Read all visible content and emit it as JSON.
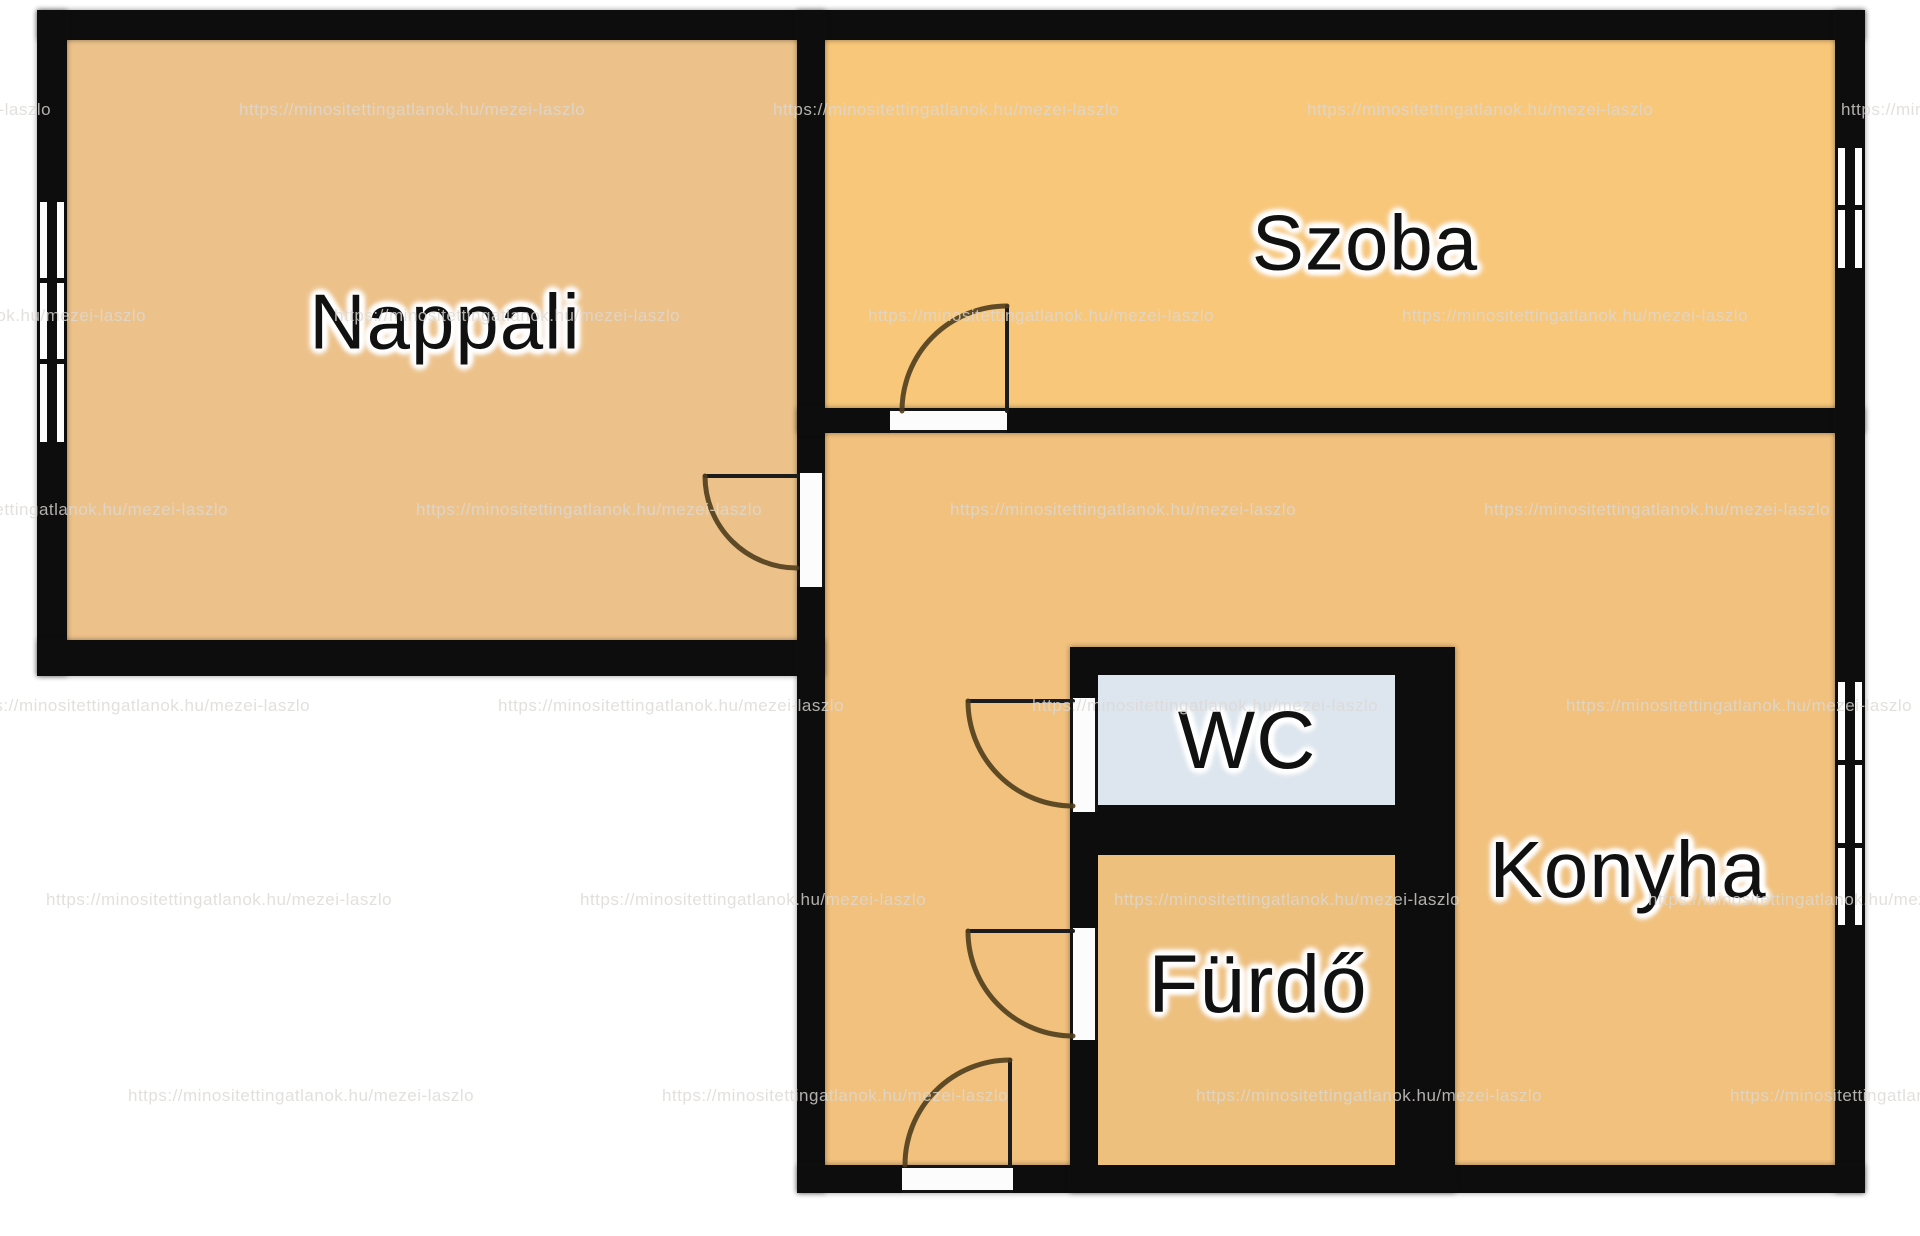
{
  "watermark": {
    "text": "https://minositettingatlanok.hu/mezei-laszlo",
    "color": "#dcd9d4",
    "pitch": 534,
    "rows": [
      {
        "y": 100,
        "x0": -295
      },
      {
        "y": 306,
        "x0": -200
      },
      {
        "y": 500,
        "x0": -118
      },
      {
        "y": 696,
        "x0": -36
      },
      {
        "y": 890,
        "x0": 46
      },
      {
        "y": 1086,
        "x0": 128
      }
    ]
  },
  "rooms": [
    {
      "name": "Nappali",
      "floor_color": "#edc28a"
    },
    {
      "name": "Szoba",
      "floor_color": "#f8c77a"
    },
    {
      "name": "Konyha",
      "floor_color": "#f1c17d"
    },
    {
      "name": "WC",
      "floor_color": "#dde6ee"
    },
    {
      "name": "Fürdő",
      "floor_color": "#eec07e"
    }
  ],
  "colors": {
    "wall": "#0d0d0d",
    "outside": "#ffffff",
    "door_swing": "#4f3d1d",
    "door_leaf": "#1c1c1c",
    "label_text": "#111111",
    "label_halo": "#ffffff"
  }
}
